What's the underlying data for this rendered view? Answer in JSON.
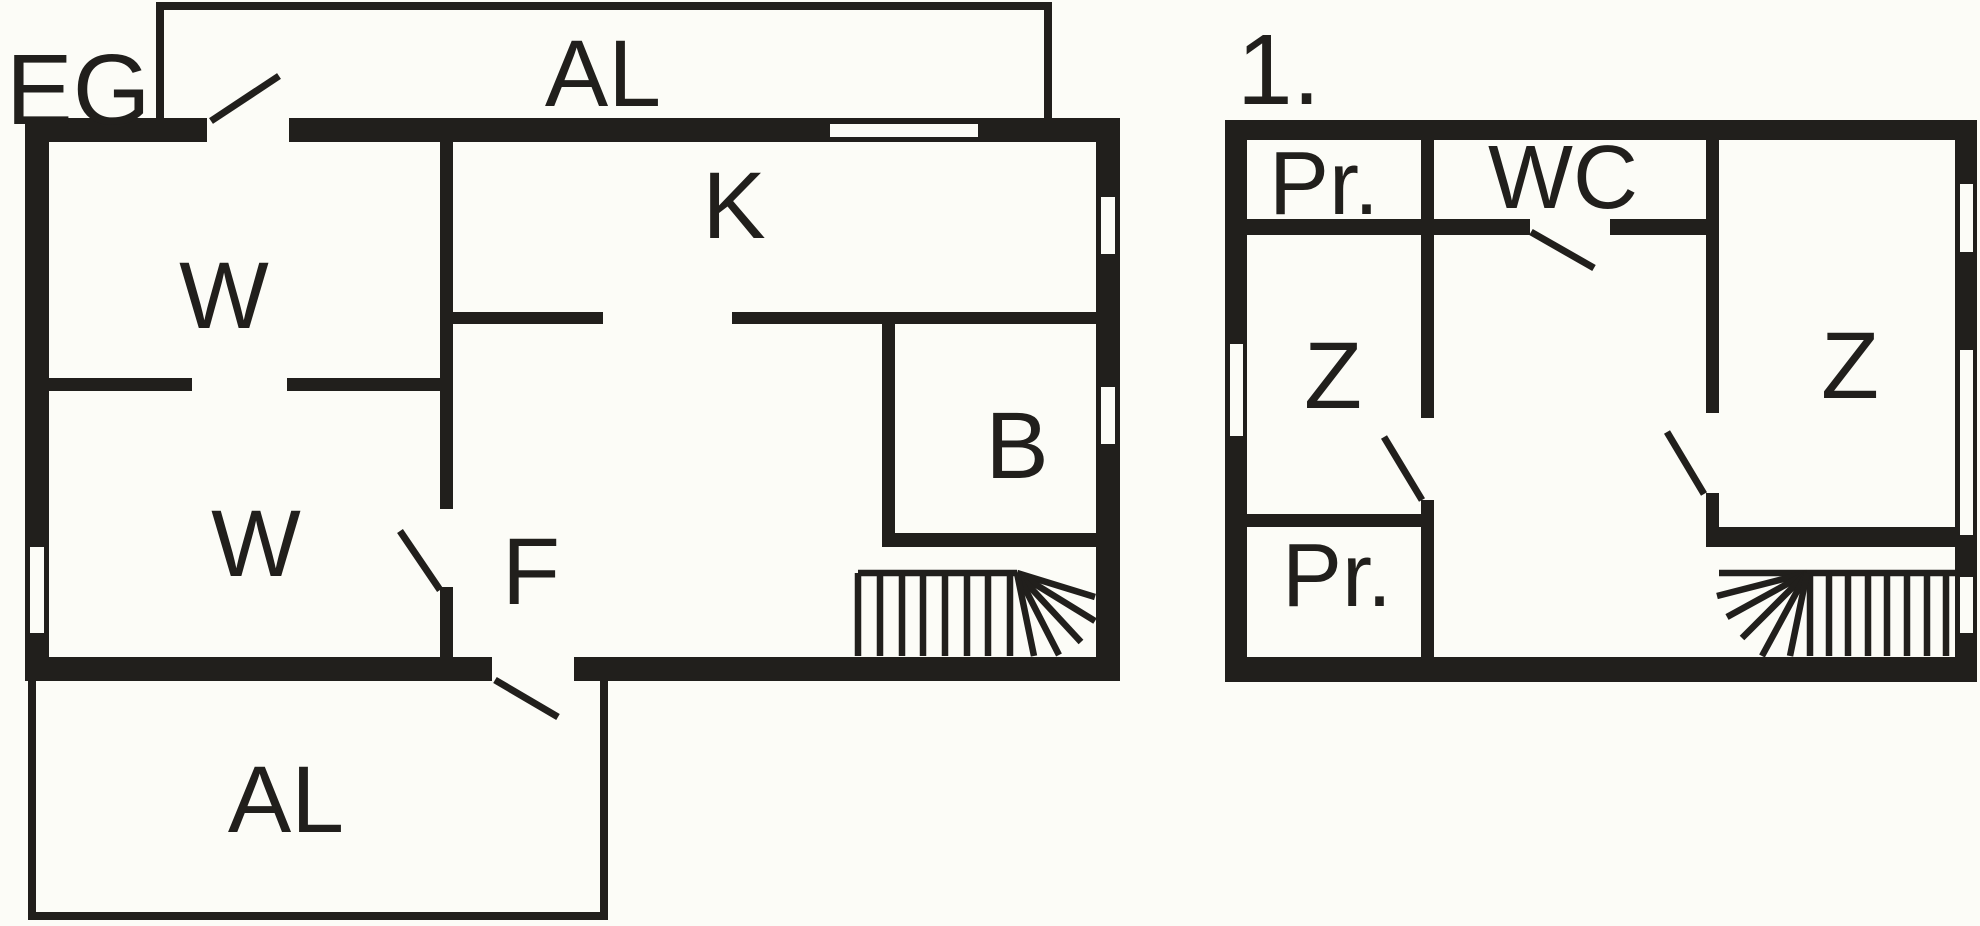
{
  "colors": {
    "background": "#fcfcf7",
    "ink": "#211f1c"
  },
  "plan": {
    "ground_floor": {
      "title": "EG",
      "balcony_top": "AL",
      "room_w_upper": "W",
      "kitchen": "K",
      "room_w_lower": "W",
      "hallway": "F",
      "bathroom": "B",
      "terrace_bottom": "AL"
    },
    "first_floor": {
      "title": "1.",
      "closet_top": "Pr.",
      "wc": "WC",
      "bedroom_left": "Z",
      "bedroom_right": "Z",
      "closet_bottom": "Pr."
    }
  }
}
